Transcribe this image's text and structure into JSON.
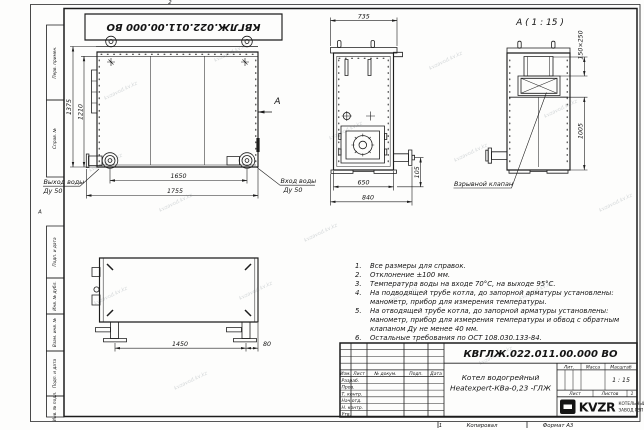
{
  "frame": {
    "zone_top": "2",
    "zone_bottom": "1",
    "zone_left": "А",
    "copied_label": "Копировал",
    "format_label": "Формат А3",
    "stamps": {
      "s1": "Перв. примен.",
      "s2": "Справ. №",
      "s3": "Подп. и дата",
      "s4": "Инв. № дубл.",
      "s5": "Взам. инв. №",
      "s6": "Подп. и дата",
      "s7": "Инв. № подл."
    }
  },
  "watermark": {
    "text": "kvzavod.kv.kz"
  },
  "views": {
    "front": {
      "dim_height_overall": "1375",
      "dim_height_body": "1210",
      "dim_width_flanges": "1650",
      "dim_width_overall": "1755",
      "outlet_label_1": "Выход воды",
      "outlet_label_2": "Ду 50",
      "inlet_label_1": "Вход воды",
      "inlet_label_2": "Ду 50",
      "view_arrow_label": "А"
    },
    "side": {
      "dim_width_top": "735",
      "dim_width_body": "650",
      "dim_width_overall": "840",
      "dim_pipe_offset": "105"
    },
    "detail_a": {
      "title": "А ( 1 : 15 )",
      "dim_valve": "150×250",
      "dim_height": "1005",
      "valve_label": "Взрывной клапан"
    },
    "bottom": {
      "dim_feet_spacing": "1450",
      "dim_edge_offset": "80"
    }
  },
  "notes": {
    "items": [
      {
        "num": "1.",
        "lines": [
          "Все размеры для справок."
        ]
      },
      {
        "num": "2.",
        "lines": [
          "Отклонение ±100 мм."
        ]
      },
      {
        "num": "3.",
        "lines": [
          "Температура воды на входе 70°С, на выходе 95°С."
        ]
      },
      {
        "num": "4.",
        "lines": [
          "На подводящей трубе котла, до запорной арматуры установлены:",
          "манометр, прибор для измерения температуры."
        ]
      },
      {
        "num": "5.",
        "lines": [
          "На отводящей трубе котла, до запорной арматуры установлены:",
          "манометр, прибор для измерения температуры и обвод с обратным",
          "клапаном Ду не менее 40 мм."
        ]
      },
      {
        "num": "6.",
        "lines": [
          "Остальные требования по ОСТ 108.030.133-84."
        ]
      }
    ]
  },
  "title_block": {
    "doc_number": "КВГЛЖ.022.011.00.000 ВО",
    "product_line1": "Котел водогрейный",
    "product_line2": "Heatexpert-КВа-0,23 -ГЛЖ",
    "col_izm": "Изм.",
    "col_list": "Лист",
    "col_doc": "№ докум.",
    "col_podp": "Подп.",
    "col_data": "Дата",
    "row_razrab": "Разраб.",
    "row_prov": "Пров.",
    "row_tkontr": "Т. контр.",
    "row_nachotd": "Нач.отд.",
    "row_nkontr": "Н. контр.",
    "row_utv": "Утв.",
    "lit_label": "Лит.",
    "mass_label": "Масса",
    "scale_label": "Масштаб",
    "scale_value": "1 : 15",
    "sheet_label": "Лист",
    "sheets_label": "Листов",
    "sheets_value": "1",
    "logo_text": "KVZR",
    "company_line1": "КОТЕЛЬНЫЙ",
    "company_line2": "ЗАВОД РЭП"
  }
}
